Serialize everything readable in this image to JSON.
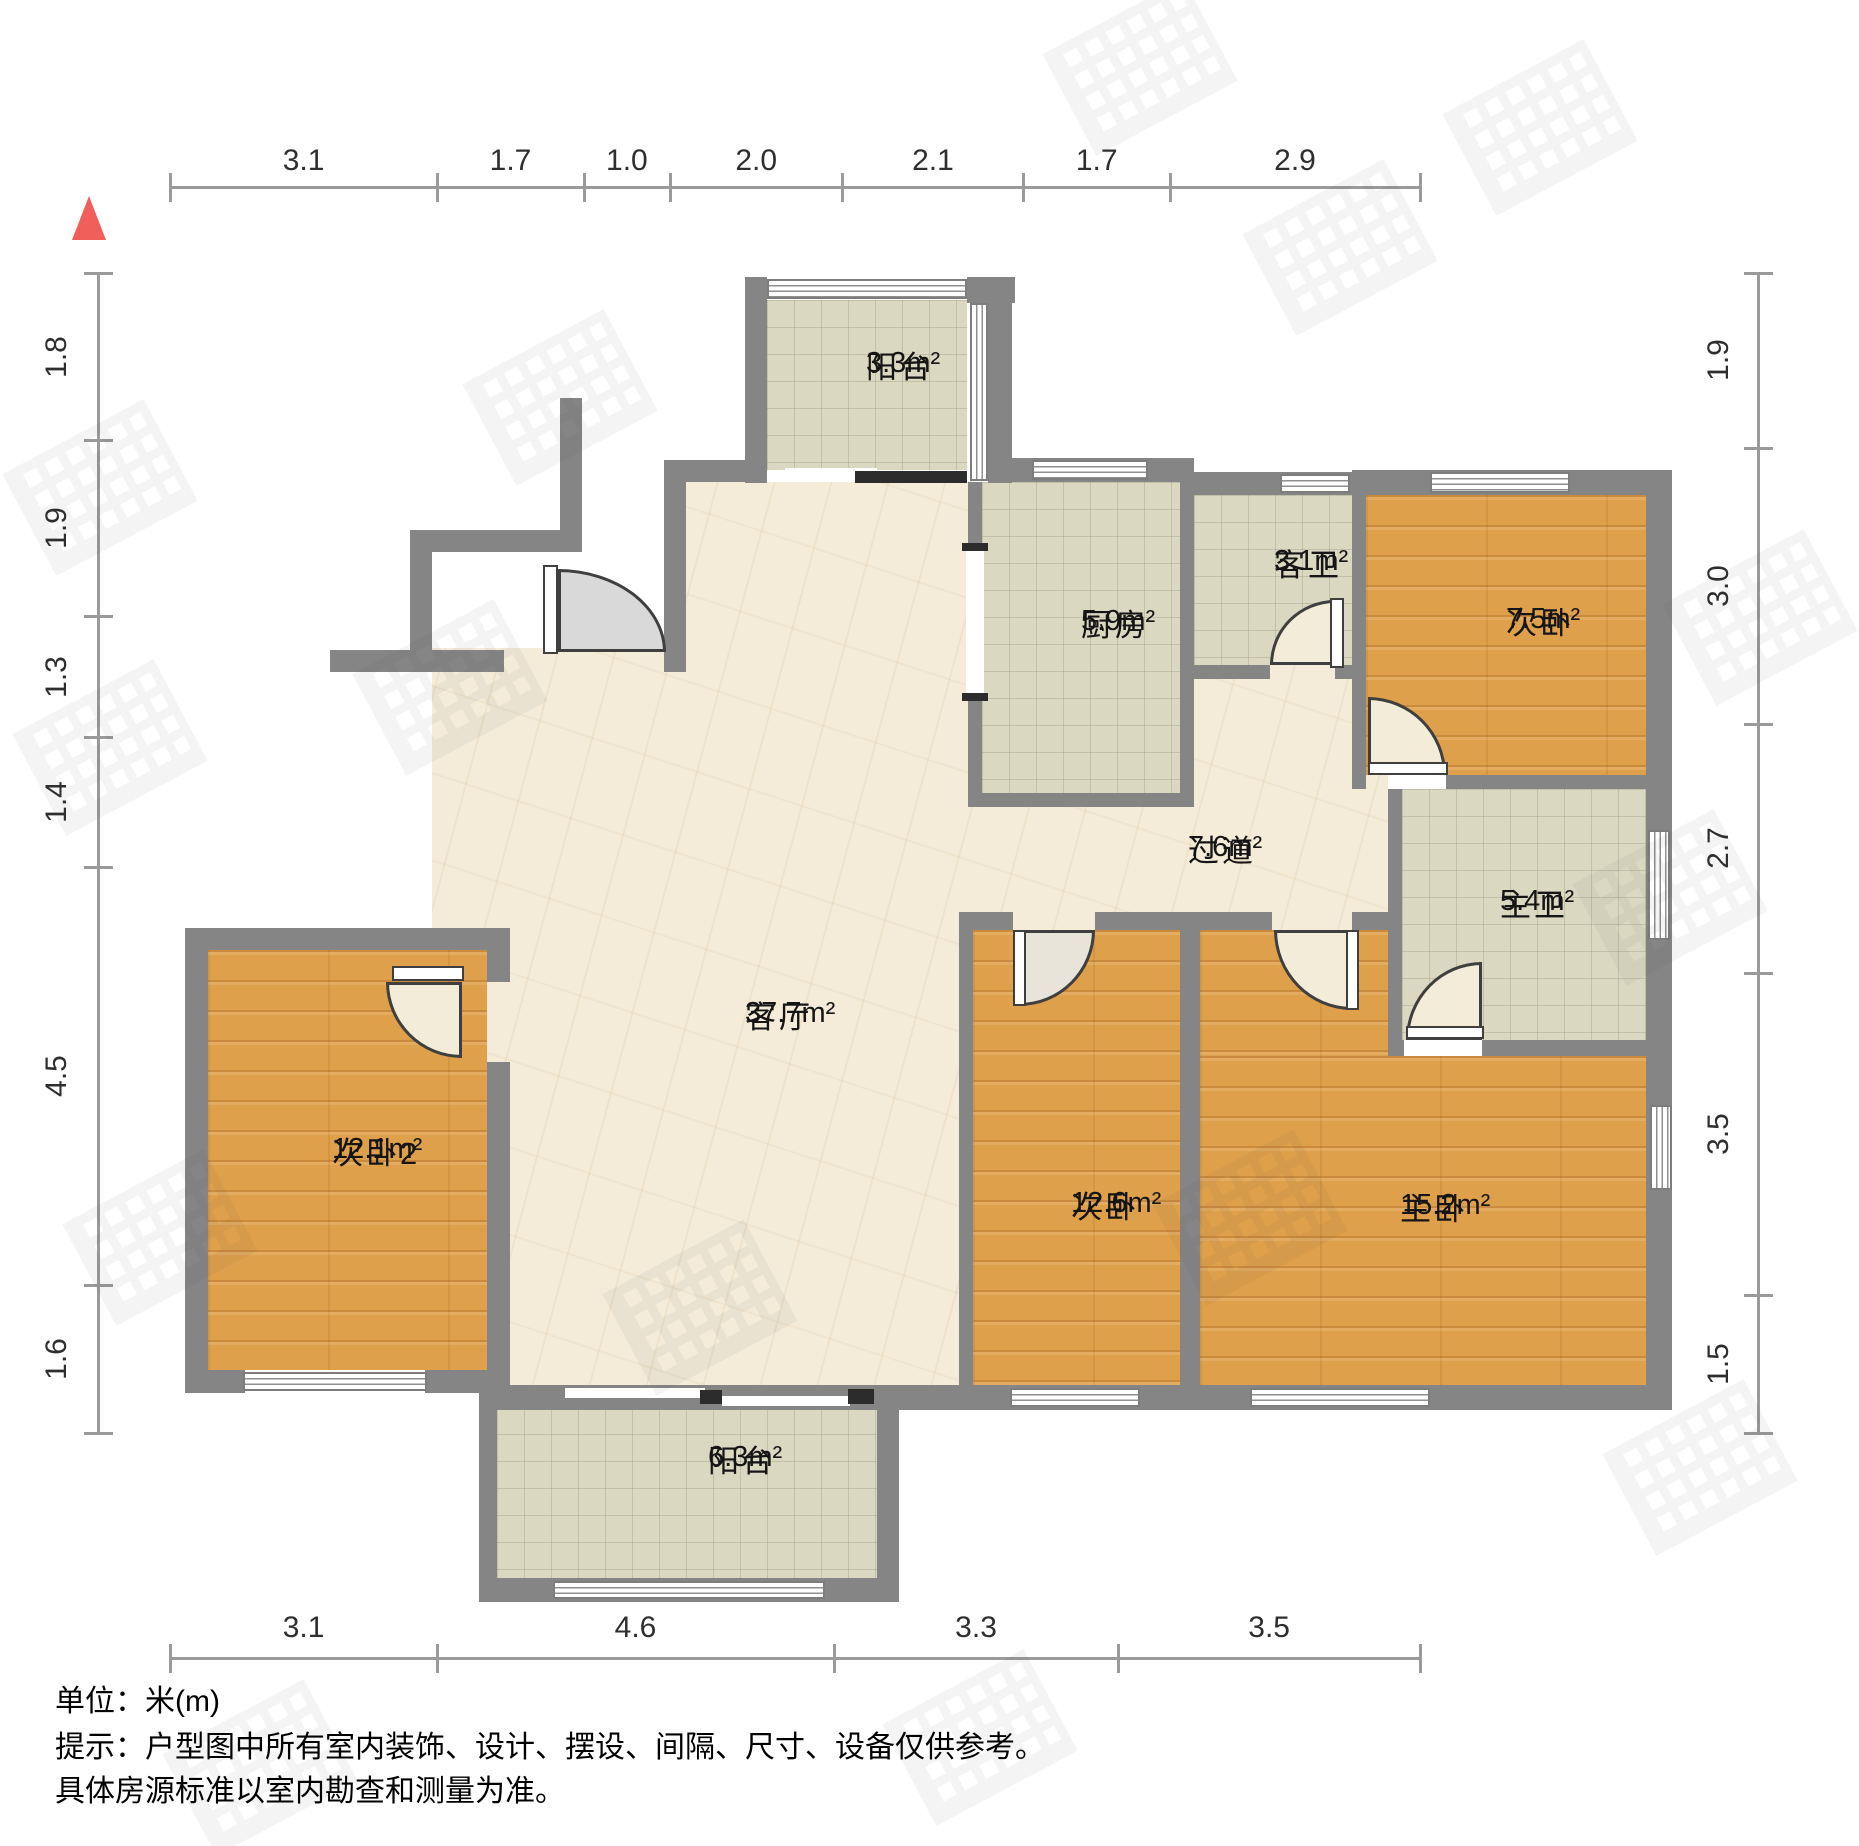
{
  "title": "户型图",
  "north_indicator": {
    "color": "#f15f5a"
  },
  "dimensions": {
    "unit": "m",
    "top": [
      "3.1",
      "1.7",
      "1.0",
      "2.0",
      "2.1",
      "1.7",
      "2.9"
    ],
    "bottom": [
      "3.1",
      "4.6",
      "3.3",
      "3.5"
    ],
    "left": [
      "1.8",
      "1.9",
      "1.3",
      "1.4",
      "4.5",
      "1.6"
    ],
    "right": [
      "1.9",
      "3.0",
      "2.7",
      "3.5",
      "1.5"
    ]
  },
  "rooms": [
    {
      "id": "balcony-top",
      "name": "阳台",
      "area": "3.3m²"
    },
    {
      "id": "kitchen",
      "name": "厨房",
      "area": "5.9m²"
    },
    {
      "id": "guest-bath",
      "name": "客卫",
      "area": "3.1m²"
    },
    {
      "id": "bedroom-top-right",
      "name": "次卧",
      "area": "7.5m²"
    },
    {
      "id": "hallway",
      "name": "过道",
      "area": "7.6m²"
    },
    {
      "id": "master-bath",
      "name": "主卫",
      "area": "5.4m²"
    },
    {
      "id": "living-room",
      "name": "客厅",
      "area": "37.7m²"
    },
    {
      "id": "bedroom-left",
      "name": "次卧2",
      "area": "12.1m²"
    },
    {
      "id": "bedroom-bottom-middle",
      "name": "次卧",
      "area": "12.6m²"
    },
    {
      "id": "master-bedroom",
      "name": "主卧",
      "area": "15.2m²"
    },
    {
      "id": "balcony-bottom",
      "name": "阳台",
      "area": "6.3m²"
    }
  ],
  "notes": {
    "unit_note": "单位：米(m)",
    "tip_line1": "提示：户型图中所有室内装饰、设计、摆设、间隔、尺寸、设备仅供参考。",
    "tip_line2": "具体房源标准以室内勘查和测量为准。"
  },
  "colors": {
    "wall": "#858585",
    "wood_floor": "#dfa04b",
    "tile_floor": "#dbd8c2",
    "marble_floor": "#f4ecd9",
    "north_arrow": "#f15f5a"
  }
}
